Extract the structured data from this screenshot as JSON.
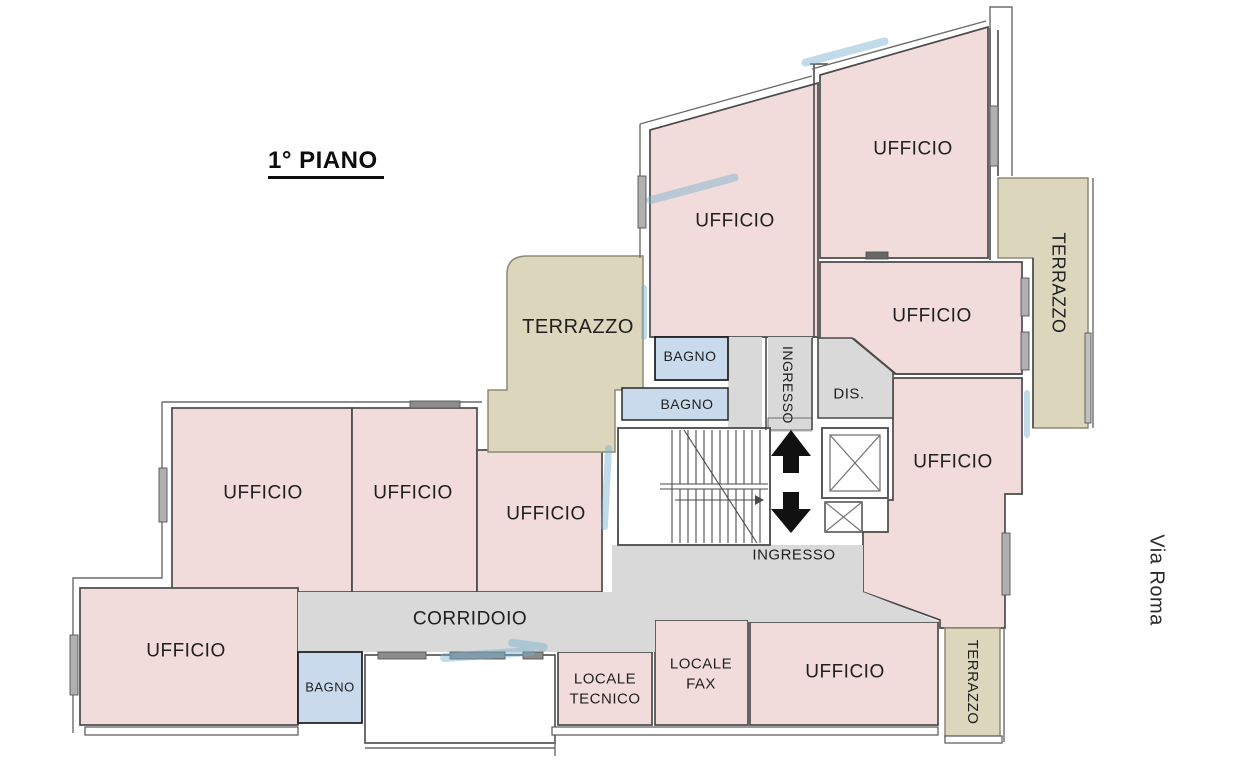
{
  "title": "1° PIANO",
  "street": "Via Roma",
  "rooms": {
    "ufficio": "UFFICIO",
    "terrazzo": "TERRAZZO",
    "bagno": "BAGNO",
    "ingresso": "INGRESSO",
    "dis": "DIS.",
    "corridoio": "CORRIDOIO",
    "locale_tecnico": {
      "line1": "LOCALE",
      "line2": "TECNICO"
    },
    "locale_fax": {
      "line1": "LOCALE",
      "line2": "FAX"
    }
  },
  "colors": {
    "room_pink": "#f2dcdb",
    "terrace_beige": "#dcd6bd",
    "corridor_gray": "#d9d9d9",
    "bath_blue": "#c9daec",
    "wall_dark": "#4a4a4a",
    "artifact_blue": "#74aed1"
  }
}
